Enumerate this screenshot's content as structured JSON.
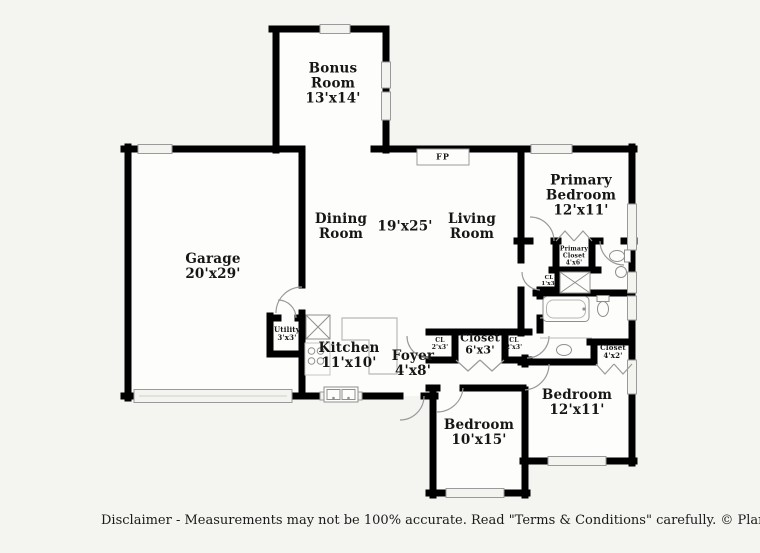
{
  "plan": {
    "rooms": {
      "bonus": {
        "lines": [
          "Bonus",
          "Room",
          "13'x14'"
        ]
      },
      "garage": {
        "lines": [
          "Garage",
          "20'x29'"
        ]
      },
      "dining": {
        "lines": [
          "Dining",
          "Room"
        ]
      },
      "main_dims": {
        "lines": [
          "19'x25'"
        ]
      },
      "living": {
        "lines": [
          "Living",
          "Room"
        ]
      },
      "primary": {
        "lines": [
          "Primary",
          "Bedroom",
          "12'x11'"
        ]
      },
      "kitchen": {
        "lines": [
          "Kitchen",
          "11'x10'"
        ]
      },
      "foyer": {
        "lines": [
          "Foyer",
          "4'x8'"
        ]
      },
      "utility": {
        "lines": [
          "Utility",
          "3'x3'"
        ]
      },
      "cl_left": {
        "lines": [
          "CL",
          "2'x3'"
        ]
      },
      "hall_closet": {
        "lines": [
          "Closet",
          "6'x3'"
        ]
      },
      "cl_right": {
        "lines": [
          "CL",
          "2'x3'"
        ]
      },
      "primary_closet": {
        "lines": [
          "Primary",
          "Closet",
          "4'x6'"
        ]
      },
      "cl_small": {
        "lines": [
          "CL",
          "1'x3'"
        ]
      },
      "closet_4x2": {
        "lines": [
          "Closet",
          "4'x2'"
        ]
      },
      "bedroom_10x15": {
        "lines": [
          "Bedroom",
          "10'x15'"
        ]
      },
      "bedroom_12x11": {
        "lines": [
          "Bedroom",
          "12'x11'"
        ]
      }
    },
    "fireplace_label": "FP",
    "disclaimer": "Disclaimer - Measurements may not be 100% accurate. Read \"Terms & Conditions\" carefully. © PlanOmatic",
    "colors": {
      "wall": "#000000",
      "floor": "#fdfdfb",
      "background": "#f4f4f1",
      "fixture": "#888888",
      "window_fill": "#f3f3f0"
    }
  }
}
